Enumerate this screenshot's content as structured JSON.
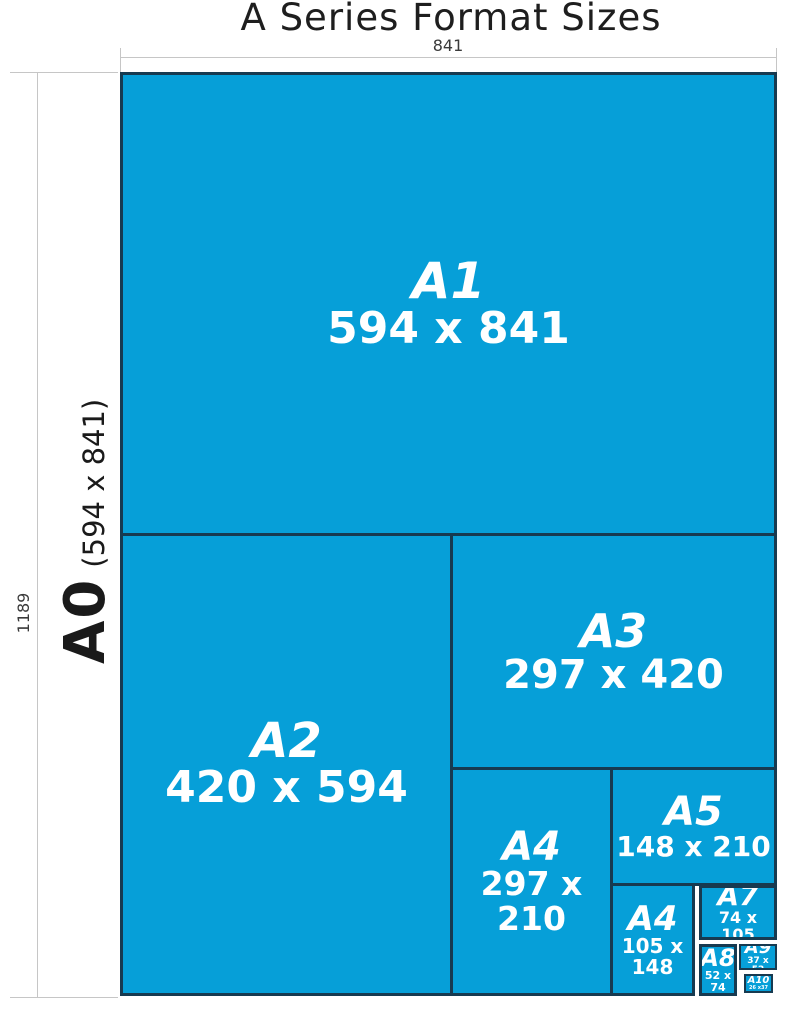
{
  "title": "A Series Format Sizes",
  "dimensions": {
    "width_label": "841",
    "height_label": "1189"
  },
  "a0": {
    "name": "A0",
    "size": "(594 x 841)"
  },
  "boxes": [
    {
      "id": "a1",
      "label": "A1",
      "size": "594 x 841"
    },
    {
      "id": "a2",
      "label": "A2",
      "size": "420 x 594"
    },
    {
      "id": "a3",
      "label": "A3",
      "size": "297 x 420"
    },
    {
      "id": "a4",
      "label": "A4",
      "size": "297 x 210"
    },
    {
      "id": "a5",
      "label": "A5",
      "size": "148 x 210"
    },
    {
      "id": "a6",
      "label": "A4",
      "size": "105 x 148"
    },
    {
      "id": "a7",
      "label": "A7",
      "size": "74 x 105"
    },
    {
      "id": "a8",
      "label": "A8",
      "size": "52 x 74"
    },
    {
      "id": "a9",
      "label": "A9",
      "size": "37 x 52"
    },
    {
      "id": "a10",
      "label": "A10",
      "size": "26 x37"
    }
  ],
  "colors": {
    "sheet_blue": "#069fd8",
    "box_border": "#173a50"
  }
}
